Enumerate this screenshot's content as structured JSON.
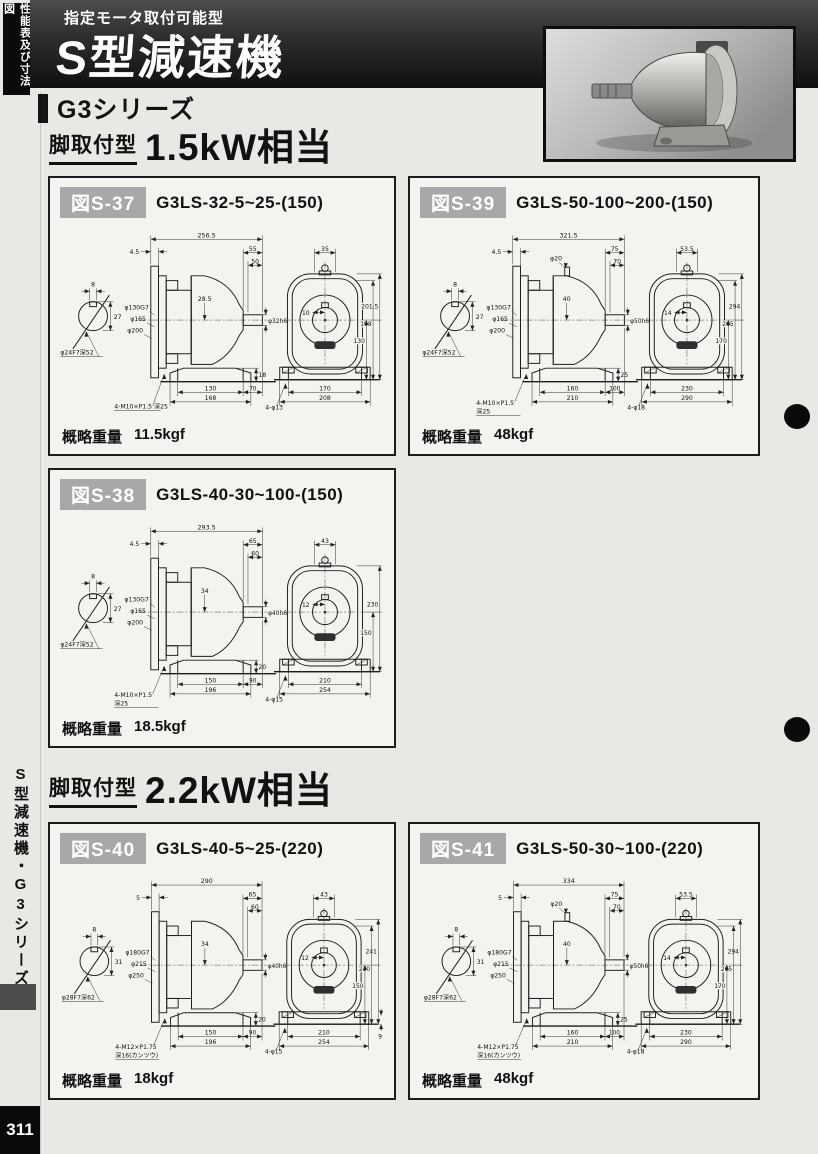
{
  "page": {
    "corner_tab": "性能表及び寸法図",
    "header_subtitle": "指定モータ取付可能型",
    "header_title": "S型減速機",
    "series_title": "G3シリーズ",
    "sidebar_text": "S型減速機・G3シリーズ",
    "page_number": "311",
    "accent_black": "#111111",
    "label_gray": "#a8a8a8"
  },
  "sections": [
    {
      "mount_label": "脚取付型",
      "power_label": "1.5kW相当"
    },
    {
      "mount_label": "脚取付型",
      "power_label": "2.2kW相当"
    }
  ],
  "weight_prefix": "概略重量",
  "figures": [
    {
      "tag": "図S-37",
      "model": "G3LS-32-5~25-(150)",
      "weight": "11.5kgf",
      "drawing": {
        "shaft_key_w": "8",
        "shaft_key_h": "27",
        "shaft_callout": "φ24F7深52",
        "total_len": "256.5",
        "flange_offset": "4.5",
        "shaft_len_outer": "55",
        "shaft_len_inner": "50",
        "grease": null,
        "flange_d1": "φ130G7",
        "flange_d2": "φ165",
        "flange_d3": "φ200",
        "shaft_height": "28.5",
        "shaft_dia": "φ32h6",
        "foot_h": "18",
        "foot_pitch": "130",
        "foot_len": "168",
        "foot_to_shaft": "70",
        "bolt_callout": [
          "4-M10×P1.5 深25"
        ],
        "front_top": "35",
        "front_hub": "10",
        "front_heights": [
          "201.5",
          "198",
          "130"
        ],
        "front_w1": "170",
        "front_w2": "208",
        "front_holes": "4-φ13",
        "front_base_extra": null
      }
    },
    {
      "tag": "図S-39",
      "model": "G3LS-50-100~200-(150)",
      "weight": "48kgf",
      "drawing": {
        "shaft_key_w": "8",
        "shaft_key_h": "27",
        "shaft_callout": "φ24F7深52",
        "total_len": "321.5",
        "flange_offset": "4.5",
        "shaft_len_outer": "75",
        "shaft_len_inner": "70",
        "grease": "φ20",
        "flange_d1": "φ130G7",
        "flange_d2": "φ165",
        "flange_d3": "φ200",
        "shaft_height": "40",
        "shaft_dia": "φ50h6",
        "foot_h": "25",
        "foot_pitch": "160",
        "foot_len": "210",
        "foot_to_shaft": "100",
        "bolt_callout": [
          "4-M10×P1.5",
          "深25"
        ],
        "front_top": "53.5",
        "front_hub": "14",
        "front_heights": [
          "294",
          "265",
          "170"
        ],
        "front_w1": "230",
        "front_w2": "290",
        "front_holes": "4-φ18",
        "front_base_extra": null
      }
    },
    {
      "tag": "図S-38",
      "model": "G3LS-40-30~100-(150)",
      "weight": "18.5kgf",
      "drawing": {
        "shaft_key_w": "8",
        "shaft_key_h": "27",
        "shaft_callout": "φ24F7深52",
        "total_len": "293.5",
        "flange_offset": "4.5",
        "shaft_len_outer": "65",
        "shaft_len_inner": "60",
        "grease": null,
        "flange_d1": "φ130G7",
        "flange_d2": "φ165",
        "flange_d3": "φ200",
        "shaft_height": "34",
        "shaft_dia": "φ40h6",
        "foot_h": "20",
        "foot_pitch": "150",
        "foot_len": "196",
        "foot_to_shaft": "90",
        "bolt_callout": [
          "4-M10×P1.5",
          "深25"
        ],
        "front_top": "43",
        "front_hub": "12",
        "front_heights": [
          "230",
          "150"
        ],
        "front_w1": "210",
        "front_w2": "254",
        "front_holes": "4-φ15",
        "front_base_extra": null
      }
    },
    {
      "tag": "図S-40",
      "model": "G3LS-40-5~25-(220)",
      "weight": "18kgf",
      "drawing": {
        "shaft_key_w": "8",
        "shaft_key_h": "31",
        "shaft_callout": "φ28F7深62",
        "total_len": "290",
        "flange_offset": "5",
        "shaft_len_outer": "65",
        "shaft_len_inner": "60",
        "grease": null,
        "flange_d1": "φ180G7",
        "flange_d2": "φ215",
        "flange_d3": "φ250",
        "shaft_height": "34",
        "shaft_dia": "φ40h6",
        "foot_h": "20",
        "foot_pitch": "150",
        "foot_len": "196",
        "foot_to_shaft": "90",
        "bolt_callout": [
          "4-M12×P1.75",
          "深16(カンツウ)"
        ],
        "front_top": "43",
        "front_hub": "12",
        "front_heights": [
          "241",
          "230",
          "150"
        ],
        "front_w1": "210",
        "front_w2": "254",
        "front_holes": "4-φ15",
        "front_base_extra": "9"
      }
    },
    {
      "tag": "図S-41",
      "model": "G3LS-50-30~100-(220)",
      "weight": "48kgf",
      "drawing": {
        "shaft_key_w": "8",
        "shaft_key_h": "31",
        "shaft_callout": "φ28F7深62",
        "total_len": "334",
        "flange_offset": "5",
        "shaft_len_outer": "75",
        "shaft_len_inner": "70",
        "grease": "φ20",
        "flange_d1": "φ180G7",
        "flange_d2": "φ215",
        "flange_d3": "φ250",
        "shaft_height": "40",
        "shaft_dia": "φ50h6",
        "foot_h": "25",
        "foot_pitch": "160",
        "foot_len": "210",
        "foot_to_shaft": "100",
        "bolt_callout": [
          "4-M12×P1.75",
          "深16(カンツウ)"
        ],
        "front_top": "53.5",
        "front_hub": "14",
        "front_heights": [
          "294",
          "265",
          "170"
        ],
        "front_w1": "230",
        "front_w2": "290",
        "front_holes": "4-φ18",
        "front_base_extra": null
      }
    }
  ]
}
